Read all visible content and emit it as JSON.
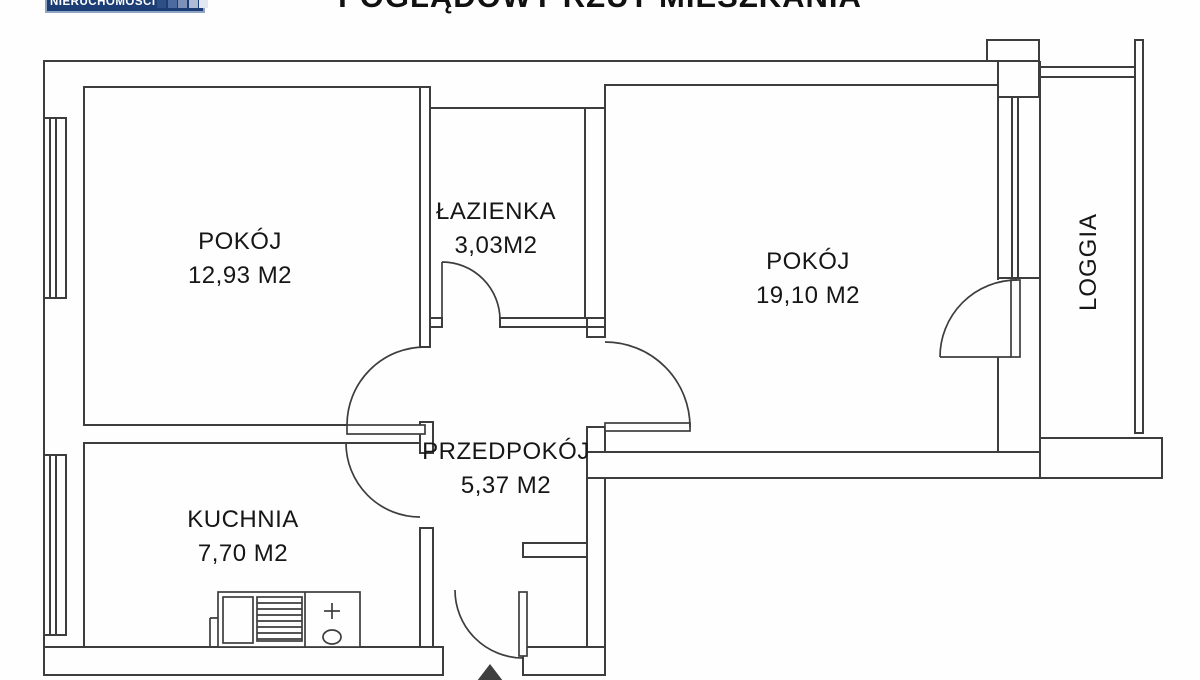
{
  "header": {
    "title": "POGLĄDOWY RZUT MIESZKANIA",
    "logo": {
      "text": "NIERUCHOMOŚCI"
    }
  },
  "rooms": {
    "room1": {
      "name": "POKÓJ",
      "area": "12,93 M2"
    },
    "bathroom": {
      "name": "ŁAZIENKA",
      "area": "3,03M2"
    },
    "room2": {
      "name": "POKÓJ",
      "area": "19,10 M2"
    },
    "hallway": {
      "name": "PRZEDPOKÓJ",
      "area": "5,37 M2"
    },
    "kitchen": {
      "name": "KUCHNIA",
      "area": "7,70 M2"
    },
    "loggia": {
      "name": "LOGGIA"
    }
  },
  "colors": {
    "wall_line": "#3d3d3d",
    "logo_navy": "#1c3e74",
    "logo_squares": [
      "#2d4f86",
      "#4d6ba0",
      "#7e91b8",
      "#aebbd3",
      "#e2e7f2"
    ],
    "text": "#161616",
    "background": "#fefefe"
  }
}
